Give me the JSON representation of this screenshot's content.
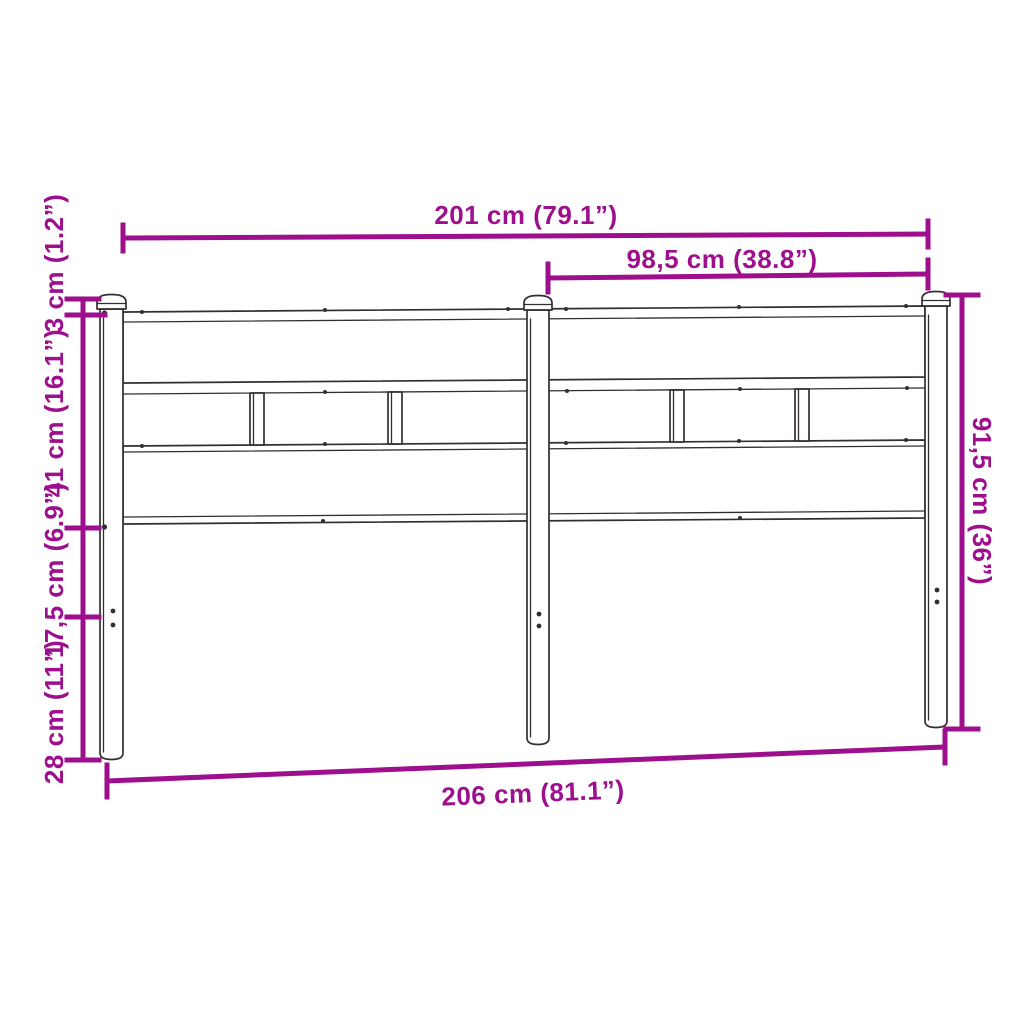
{
  "diagram": {
    "colors": {
      "dimension": "#9e0f8e",
      "outline": "#332e30",
      "background": "#ffffff"
    },
    "dimensions": {
      "top_width": "201 cm (79.1”)",
      "half_width": "98,5 cm (38.8”)",
      "cap_height": "3 cm (1.2”)",
      "panel_height": "41 cm (16.1”)",
      "gap_height": "17,5 cm (6.9”)",
      "leg_height": "28 cm (11”)",
      "total_height": "91,5 cm (36”)",
      "bottom_width": "206 cm (81.1”)"
    }
  }
}
